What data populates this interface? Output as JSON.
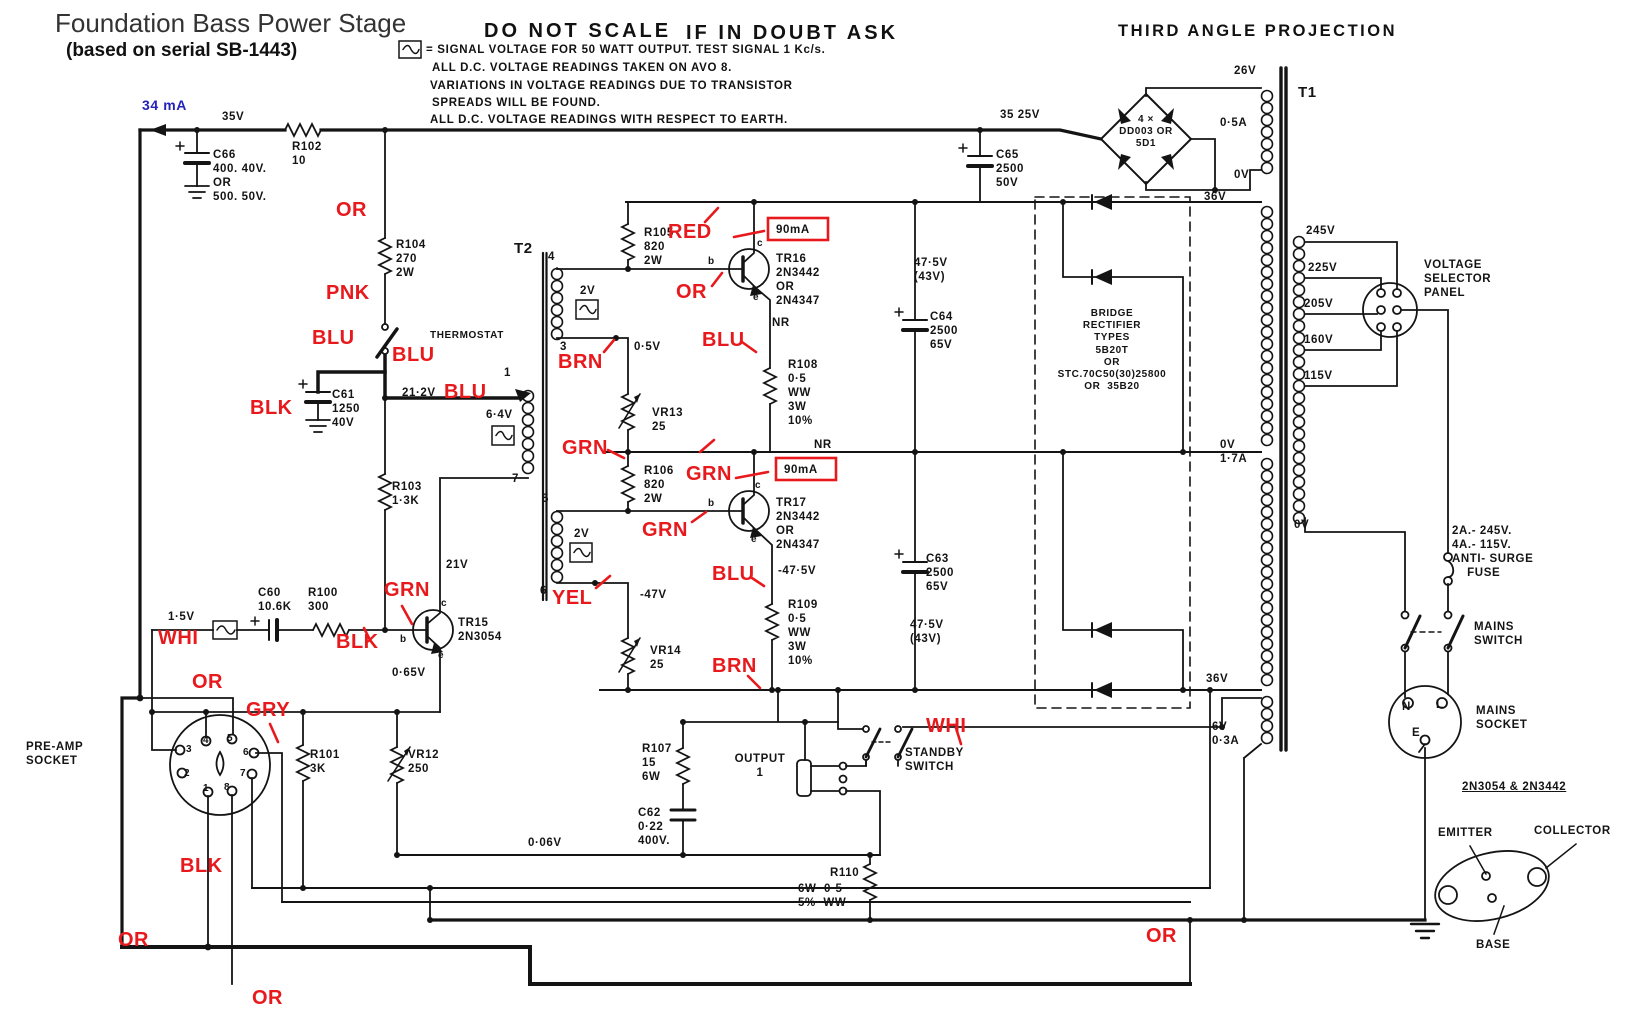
{
  "colors": {
    "ink": "#141414",
    "red": "#e8191c",
    "blue": "#2323bb",
    "paper": "#ffffff"
  },
  "header": {
    "title": "Foundation Bass Power Stage",
    "subtitle": "(based on serial SB-1443)",
    "warning_left": "DO NOT SCALE",
    "warning_right": "IF IN DOUBT ASK",
    "projection": "THIRD ANGLE PROJECTION",
    "current_annotation": "34 mA"
  },
  "notes": {
    "line1": "= SIGNAL VOLTAGE FOR 50 WATT OUTPUT.  TEST SIGNAL 1 Kc/s.",
    "line2": "ALL D.C. VOLTAGE READINGS TAKEN ON AVO 8.",
    "line3": "VARIATIONS IN VOLTAGE READINGS DUE TO TRANSISTOR",
    "line4": "SPREADS WILL BE FOUND.",
    "line5": "ALL D.C. VOLTAGE READINGS WITH RESPECT TO EARTH."
  },
  "labels": [
    {
      "n": "lbl-35v",
      "t": "35V",
      "x": 222,
      "y": 110
    },
    {
      "n": "lbl-r102",
      "t": "R102\n10",
      "x": 292,
      "y": 140
    },
    {
      "n": "lbl-c66",
      "t": "C66\n400. 40V.\nOR\n500. 50V.",
      "x": 213,
      "y": 148
    },
    {
      "n": "lbl-35-25v",
      "t": "35 25V",
      "x": 1000,
      "y": 108
    },
    {
      "n": "lbl-bridge-main",
      "t": "4 ×\nDD003 OR\n5D1",
      "x": 1106,
      "y": 114,
      "c": "hw-c hw-sm",
      "w": 80
    },
    {
      "n": "lbl-26v",
      "t": "26V",
      "x": 1234,
      "y": 64
    },
    {
      "n": "lbl-0-5a",
      "t": "0·5A",
      "x": 1220,
      "y": 116
    },
    {
      "n": "lbl-0v-sec",
      "t": "0V",
      "x": 1234,
      "y": 168
    },
    {
      "n": "lbl-t1",
      "t": "T1",
      "x": 1298,
      "y": 84,
      "c": "hw-lg"
    },
    {
      "n": "lbl-c65",
      "t": "C65\n2500\n50V",
      "x": 996,
      "y": 148
    },
    {
      "n": "lbl-36v-top",
      "t": "36V",
      "x": 1204,
      "y": 190
    },
    {
      "n": "lbl-245v",
      "t": "245V",
      "x": 1306,
      "y": 224
    },
    {
      "n": "lbl-225v",
      "t": "225V",
      "x": 1308,
      "y": 261
    },
    {
      "n": "lbl-205v",
      "t": "205V",
      "x": 1304,
      "y": 297
    },
    {
      "n": "lbl-160v",
      "t": "160V",
      "x": 1304,
      "y": 333
    },
    {
      "n": "lbl-115v",
      "t": "115V",
      "x": 1304,
      "y": 369
    },
    {
      "n": "lbl-selector",
      "t": "VOLTAGE\nSELECTOR\nPANEL",
      "x": 1424,
      "y": 258
    },
    {
      "n": "lbl-0v-17a",
      "t": "0V\n1·7A",
      "x": 1220,
      "y": 438
    },
    {
      "n": "lbl-0v-prim",
      "t": "0V",
      "x": 1294,
      "y": 518
    },
    {
      "n": "lbl-fuse",
      "t": "2A.- 245V.\n4A.- 115V.\nANTI- SURGE\n    FUSE",
      "x": 1452,
      "y": 524
    },
    {
      "n": "lbl-mains-switch",
      "t": "MAINS\nSWITCH",
      "x": 1474,
      "y": 620
    },
    {
      "n": "lbl-mains-socket",
      "t": "MAINS\nSOCKET",
      "x": 1476,
      "y": 704
    },
    {
      "n": "lbl-pin-n",
      "t": "N",
      "x": 1402,
      "y": 700
    },
    {
      "n": "lbl-pin-l",
      "t": "L",
      "x": 1436,
      "y": 698
    },
    {
      "n": "lbl-pin-e",
      "t": "E",
      "x": 1412,
      "y": 726
    },
    {
      "n": "lbl-36v-bot",
      "t": "36V",
      "x": 1206,
      "y": 672
    },
    {
      "n": "lbl-6v",
      "t": "6V\n0·3A",
      "x": 1212,
      "y": 720
    },
    {
      "n": "lbl-pinout-title",
      "t": "2N3054 & 2N3442",
      "x": 1462,
      "y": 780,
      "c": "hw-u"
    },
    {
      "n": "lbl-emitter",
      "t": "EMITTER",
      "x": 1438,
      "y": 826
    },
    {
      "n": "lbl-collector",
      "t": "COLLECTOR",
      "x": 1534,
      "y": 824
    },
    {
      "n": "lbl-base",
      "t": "BASE",
      "x": 1476,
      "y": 938
    },
    {
      "n": "lbl-475v-1",
      "t": "47·5V\n(43V)",
      "x": 914,
      "y": 256
    },
    {
      "n": "lbl-c64",
      "t": "C64\n2500\n65V",
      "x": 930,
      "y": 310
    },
    {
      "n": "lbl-bridge-box",
      "t": "BRIDGE\nRECTIFIER\nTYPES\n5B20T\nOR\nSTC.70C50(30)25800\nOR  35B20",
      "x": 1037,
      "y": 308,
      "c": "hw-c hw-sm",
      "w": 150
    },
    {
      "n": "lbl-c63",
      "t": "C63\n2500\n65V",
      "x": 926,
      "y": 552
    },
    {
      "n": "lbl-475v-2",
      "t": "47·5V\n(43V)",
      "x": 910,
      "y": 618
    },
    {
      "n": "lbl-r104",
      "t": "R104\n270\n2W",
      "x": 396,
      "y": 238
    },
    {
      "n": "lbl-thermostat",
      "t": "THERMOSTAT",
      "x": 430,
      "y": 330,
      "c": "hw-sm"
    },
    {
      "n": "lbl-c61",
      "t": "C61\n1250\n40V",
      "x": 332,
      "y": 388
    },
    {
      "n": "lbl-21-2v",
      "t": "21·2V",
      "x": 402,
      "y": 386
    },
    {
      "n": "lbl-r103",
      "t": "R103\n1·3K",
      "x": 392,
      "y": 480
    },
    {
      "n": "lbl-21v",
      "t": "21V",
      "x": 446,
      "y": 558
    },
    {
      "n": "lbl-t2",
      "t": "T2",
      "x": 514,
      "y": 240,
      "c": "hw-lg"
    },
    {
      "n": "lbl-term4",
      "t": "4",
      "x": 548,
      "y": 250
    },
    {
      "n": "lbl-term3",
      "t": "3",
      "x": 560,
      "y": 340
    },
    {
      "n": "lbl-term5",
      "t": "5",
      "x": 542,
      "y": 492
    },
    {
      "n": "lbl-term6",
      "t": "6",
      "x": 540,
      "y": 584
    },
    {
      "n": "lbl-term7",
      "t": "7",
      "x": 512,
      "y": 472
    },
    {
      "n": "lbl-term1",
      "t": "1",
      "x": 504,
      "y": 366
    },
    {
      "n": "lbl-2v-a",
      "t": "2V",
      "x": 580,
      "y": 284
    },
    {
      "n": "lbl-2v-b",
      "t": "2V",
      "x": 574,
      "y": 527
    },
    {
      "n": "lbl-6-4v",
      "t": "6·4V",
      "x": 486,
      "y": 408
    },
    {
      "n": "lbl-r105",
      "t": "R105\n820\n2W",
      "x": 644,
      "y": 226
    },
    {
      "n": "lbl-0-5v",
      "t": "0·5V",
      "x": 634,
      "y": 340
    },
    {
      "n": "lbl-vr13",
      "t": "VR13\n25",
      "x": 652,
      "y": 406
    },
    {
      "n": "lbl-tr16",
      "t": "TR16\n2N3442\nOR\n2N4347",
      "x": 776,
      "y": 252
    },
    {
      "n": "lbl-nr1",
      "t": "NR",
      "x": 772,
      "y": 316
    },
    {
      "n": "lbl-r108",
      "t": "R108\n0·5\nWW\n3W\n10%",
      "x": 788,
      "y": 358
    },
    {
      "n": "lbl-90ma-1",
      "t": "90mA",
      "x": 776,
      "y": 223
    },
    {
      "n": "lbl-90ma-2",
      "t": "90mA",
      "x": 784,
      "y": 463
    },
    {
      "n": "lbl-tr17",
      "t": "TR17\n2N3442\nOR\n2N4347",
      "x": 776,
      "y": 496
    },
    {
      "n": "lbl-nr2",
      "t": "NR",
      "x": 814,
      "y": 438
    },
    {
      "n": "lbl-r106",
      "t": "R106\n820\n2W",
      "x": 644,
      "y": 464
    },
    {
      "n": "lbl-m47v",
      "t": "-47V",
      "x": 640,
      "y": 588
    },
    {
      "n": "lbl-m475v",
      "t": "-47·5V",
      "x": 778,
      "y": 564
    },
    {
      "n": "lbl-vr14",
      "t": "VR14\n25",
      "x": 650,
      "y": 644
    },
    {
      "n": "lbl-r109",
      "t": "R109\n0·5\nWW\n3W\n10%",
      "x": 788,
      "y": 598
    },
    {
      "n": "lbl-tr15",
      "t": "TR15\n2N3054",
      "x": 458,
      "y": 616
    },
    {
      "n": "lbl-0-65v",
      "t": "0·65V",
      "x": 392,
      "y": 666
    },
    {
      "n": "lbl-1-5v",
      "t": "1·5V",
      "x": 168,
      "y": 610
    },
    {
      "n": "lbl-c60",
      "t": "C60\n10.6K",
      "x": 258,
      "y": 586
    },
    {
      "n": "lbl-r100",
      "t": "R100\n300",
      "x": 308,
      "y": 586
    },
    {
      "n": "lbl-preamp",
      "t": "PRE-AMP\nSOCKET",
      "x": 26,
      "y": 740
    },
    {
      "n": "lbl-pp3",
      "t": "3",
      "x": 186,
      "y": 744,
      "c": "hw-sm"
    },
    {
      "n": "lbl-pp4",
      "t": "4",
      "x": 203,
      "y": 735,
      "c": "hw-sm"
    },
    {
      "n": "lbl-pp5",
      "t": "5",
      "x": 227,
      "y": 733,
      "c": "hw-sm"
    },
    {
      "n": "lbl-pp6",
      "t": "6",
      "x": 243,
      "y": 747,
      "c": "hw-sm"
    },
    {
      "n": "lbl-pp2",
      "t": "2",
      "x": 184,
      "y": 768,
      "c": "hw-sm"
    },
    {
      "n": "lbl-pp7",
      "t": "7",
      "x": 240,
      "y": 768,
      "c": "hw-sm"
    },
    {
      "n": "lbl-pp1",
      "t": "1",
      "x": 203,
      "y": 783,
      "c": "hw-sm"
    },
    {
      "n": "lbl-pp8",
      "t": "8",
      "x": 224,
      "y": 782,
      "c": "hw-sm"
    },
    {
      "n": "lbl-r101",
      "t": "R101\n3K",
      "x": 310,
      "y": 748
    },
    {
      "n": "lbl-vr12",
      "t": "VR12\n250",
      "x": 408,
      "y": 748
    },
    {
      "n": "lbl-r107",
      "t": "R107\n15\n6W",
      "x": 642,
      "y": 742
    },
    {
      "n": "lbl-c62",
      "t": "C62\n0·22\n400V.",
      "x": 638,
      "y": 806
    },
    {
      "n": "lbl-output",
      "t": "OUTPUT\n1",
      "x": 730,
      "y": 752,
      "c": "hw-c",
      "w": 60
    },
    {
      "n": "lbl-standby",
      "t": "STANDBY\nSWITCH",
      "x": 905,
      "y": 746
    },
    {
      "n": "lbl-r110a",
      "t": "R110",
      "x": 830,
      "y": 866
    },
    {
      "n": "lbl-r110b",
      "t": "6W  0·5\n5%  WW",
      "x": 798,
      "y": 882
    },
    {
      "n": "lbl-0-06v",
      "t": "0·06V",
      "x": 528,
      "y": 836
    },
    {
      "n": "lbl-b16",
      "t": "b",
      "x": 708,
      "y": 256,
      "c": "hw-sm"
    },
    {
      "n": "lbl-c16",
      "t": "c",
      "x": 757,
      "y": 238,
      "c": "hw-sm"
    },
    {
      "n": "lbl-e16",
      "t": "e",
      "x": 753,
      "y": 292,
      "c": "hw-sm"
    },
    {
      "n": "lbl-b17",
      "t": "b",
      "x": 708,
      "y": 498,
      "c": "hw-sm"
    },
    {
      "n": "lbl-c17",
      "t": "c",
      "x": 755,
      "y": 480,
      "c": "hw-sm"
    },
    {
      "n": "lbl-e17",
      "t": "e",
      "x": 751,
      "y": 534,
      "c": "hw-sm"
    },
    {
      "n": "lbl-b15",
      "t": "b",
      "x": 400,
      "y": 634,
      "c": "hw-sm"
    },
    {
      "n": "lbl-c15",
      "t": "c",
      "x": 441,
      "y": 598,
      "c": "hw-sm"
    },
    {
      "n": "lbl-e15",
      "t": "e",
      "x": 438,
      "y": 650,
      "c": "hw-sm"
    },
    {
      "n": "wire-or-1",
      "t": "OR",
      "x": 336,
      "y": 200,
      "c": "red"
    },
    {
      "n": "wire-pnk",
      "t": "PNK",
      "x": 326,
      "y": 283,
      "c": "red"
    },
    {
      "n": "wire-blu-1",
      "t": "BLU",
      "x": 312,
      "y": 328,
      "c": "red"
    },
    {
      "n": "wire-blu-2",
      "t": "BLU",
      "x": 392,
      "y": 345,
      "c": "red"
    },
    {
      "n": "wire-blk-1",
      "t": "BLK",
      "x": 250,
      "y": 398,
      "c": "red"
    },
    {
      "n": "wire-blu-3",
      "t": "BLU",
      "x": 444,
      "y": 382,
      "c": "red"
    },
    {
      "n": "wire-red",
      "t": "RED",
      "x": 668,
      "y": 222,
      "c": "red"
    },
    {
      "n": "wire-or-2",
      "t": "OR",
      "x": 676,
      "y": 282,
      "c": "red"
    },
    {
      "n": "wire-brn-1",
      "t": "BRN",
      "x": 558,
      "y": 352,
      "c": "red"
    },
    {
      "n": "wire-blu-4",
      "t": "BLU",
      "x": 702,
      "y": 330,
      "c": "red"
    },
    {
      "n": "wire-grn-1",
      "t": "GRN",
      "x": 562,
      "y": 438,
      "c": "red"
    },
    {
      "n": "wire-grn-2",
      "t": "GRN",
      "x": 686,
      "y": 464,
      "c": "red"
    },
    {
      "n": "wire-grn-3",
      "t": "GRN",
      "x": 642,
      "y": 520,
      "c": "red"
    },
    {
      "n": "wire-yel",
      "t": "YEL",
      "x": 552,
      "y": 588,
      "c": "red"
    },
    {
      "n": "wire-blu-5",
      "t": "BLU",
      "x": 712,
      "y": 564,
      "c": "red"
    },
    {
      "n": "wire-brn-2",
      "t": "BRN",
      "x": 712,
      "y": 656,
      "c": "red"
    },
    {
      "n": "wire-grn-4",
      "t": "GRN",
      "x": 384,
      "y": 580,
      "c": "red"
    },
    {
      "n": "wire-blk-2",
      "t": "BLK",
      "x": 336,
      "y": 632,
      "c": "red"
    },
    {
      "n": "wire-whi-1",
      "t": "WHI",
      "x": 158,
      "y": 628,
      "c": "red"
    },
    {
      "n": "wire-or-3",
      "t": "OR",
      "x": 192,
      "y": 672,
      "c": "red"
    },
    {
      "n": "wire-gry",
      "t": "GRY",
      "x": 246,
      "y": 700,
      "c": "red"
    },
    {
      "n": "wire-blk-3",
      "t": "BLK",
      "x": 180,
      "y": 856,
      "c": "red"
    },
    {
      "n": "wire-or-4",
      "t": "OR",
      "x": 118,
      "y": 930,
      "c": "red"
    },
    {
      "n": "wire-or-5",
      "t": "OR",
      "x": 252,
      "y": 988,
      "c": "red"
    },
    {
      "n": "wire-or-6",
      "t": "OR",
      "x": 1146,
      "y": 926,
      "c": "red"
    },
    {
      "n": "wire-whi-2",
      "t": "WHI",
      "x": 926,
      "y": 716,
      "c": "red"
    }
  ]
}
